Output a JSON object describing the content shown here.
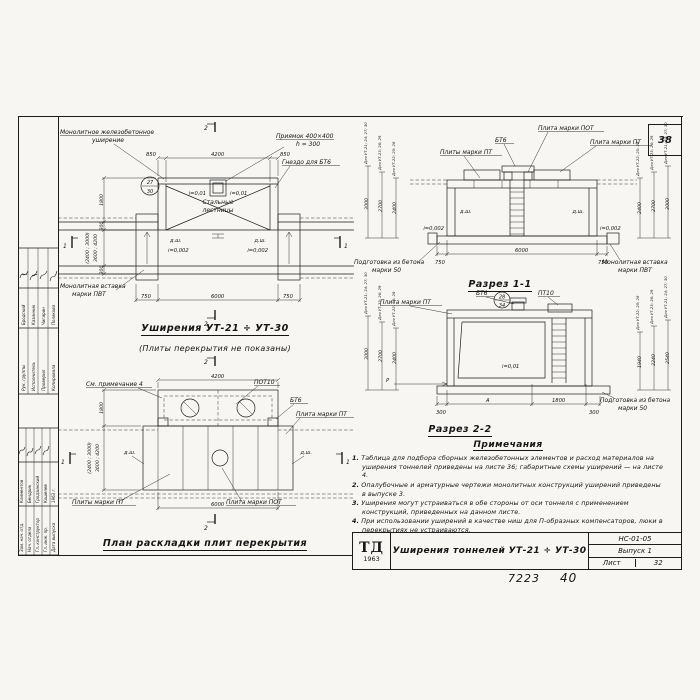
{
  "marks": {
    "one": "1",
    "two": "2"
  },
  "sheet": {
    "corner_page": "38",
    "footer_number": "7223",
    "footer_page": "40"
  },
  "titleblock": {
    "logo": "ТД",
    "logo_year": "1963",
    "title": "Уширения тоннелей УТ-21 ÷ УТ-30",
    "code": "НС-01-05",
    "issue": "Выпуск 1",
    "sheet_label": "Лист",
    "sheet_number": "32"
  },
  "sidebar": {
    "table1": {
      "roles": [
        "Рук. группы",
        "Исполнитель",
        "Проверил",
        "Копировала"
      ],
      "names": [
        "Бродский",
        "Казинник",
        "Чигирин",
        "Полякова"
      ]
    },
    "table2": {
      "roles": [
        "Зам. нач. отд.",
        "Нач. отдела",
        "Гл. конструктор",
        "Гл. инж. пр.",
        "Дата выпуска"
      ],
      "names": [
        "Климентов",
        "Бендрик",
        "Гродзинский",
        "Кошелев",
        "1963 г."
      ]
    }
  },
  "plan_top": {
    "title": "Уширения УТ-21 ÷ УТ-30",
    "subtitle": "(Плиты перекрытия не показаны)",
    "label_monolithic_1": "Монолитное железобетонное",
    "label_monolithic_2": "уширение",
    "label_pit_1": "Приямок 400×400",
    "label_pit_2": "h = 300",
    "label_socket": "Гнездо для БТ6",
    "label_stairs_1": "Стальные",
    "label_stairs_2": "лестницы",
    "label_insert_1": "Монолитная вставка",
    "label_insert_2": "марки ПВТ",
    "callout_top": "27",
    "callout_bottom": "30",
    "slope_pit": "i=0,01",
    "slope_wall": "i=0,002",
    "joint": "д.ш.",
    "dim_850": "850",
    "dim_4200": "4200",
    "dim_750": "750",
    "dim_6000": "6000",
    "dim_1800": "1800",
    "dim_300": "300",
    "dim_span_1": "(2400 ; 3000)",
    "dim_span_2": "3600 ; 4200"
  },
  "section1": {
    "title": "Разрез 1-1",
    "label_bt6": "БТ6",
    "label_pot": "Плита марки ПОТ",
    "label_pt": "Плита марки ПТ",
    "label_pts": "Плиты марки ПТ",
    "label_podg_1": "Подготовка из бетона",
    "label_podg_2": "марки 50",
    "label_insert_1": "Монолитная вставка",
    "label_insert_2": "марки ПВТ",
    "joint": "д.ш.",
    "slope": "i=0,002",
    "dim_750": "750",
    "dim_6000": "6000",
    "left_cols": [
      {
        "label": "Для УТ-21; 24; 27; 30",
        "value": "3000"
      },
      {
        "label": "Для УТ-23; 26; 29",
        "value": "2700"
      },
      {
        "label": "Для УТ-22; 25; 28",
        "value": "2400"
      }
    ],
    "right_cols": [
      {
        "label": "Для УТ-22; 25; 28",
        "value": "2400"
      },
      {
        "label": "Для УТ-23; 26; 29",
        "value": "2700"
      },
      {
        "label": "Для УТ-21; 24; 27; 30",
        "value": "3000"
      }
    ]
  },
  "section2": {
    "title": "Разрез 2-2",
    "label_pt": "Плита марки ПТ",
    "label_bt6": "БТ6",
    "label_pt10": "ПТ10",
    "label_podg_1": "Подготовка из бетона",
    "label_podg_2": "марки 50",
    "slope": "i=0,01",
    "load": "Р",
    "callout_top": "28",
    "callout_bottom": "34",
    "dim_300": "300",
    "dim_a": "А",
    "dim_1800": "1800",
    "left_cols": [
      {
        "label": "Для УТ-21; 24; 27; 30",
        "value": "3000"
      },
      {
        "label": "Для УТ-23; 26; 29",
        "value": "2700"
      },
      {
        "label": "Для УТ-22; 25; 28",
        "value": "2400"
      }
    ],
    "right_cols": [
      {
        "label": "Для УТ-22; 25; 28",
        "value": "1940"
      },
      {
        "label": "Для УТ-23; 26; 29",
        "value": "2240"
      },
      {
        "label": "Для УТ-21; 24; 27; 30",
        "value": "2540"
      }
    ]
  },
  "plan_bottom": {
    "title": "План раскладки плит перекрытия",
    "label_note": "См. примечание 4",
    "label_pot10": "ПОТ10",
    "label_bt6": "БТ6",
    "label_pt": "Плита марки ПТ",
    "label_pts": "Плиты марки ПТ",
    "label_pot": "Плита марки ПОТ",
    "joint": "д.ш.",
    "dim_4200": "4200",
    "dim_6000": "6000",
    "dim_1800": "1800",
    "dim_span_1": "(2400 ; 3000)",
    "dim_span_2": "3600 ; 4200"
  },
  "notes": {
    "title": "Примечания",
    "items": [
      "Таблица для подбора сборных железобетонных элементов и расход материалов на уширения тоннелей приведены на листе 36; габаритные схемы уширений — на листе 4.",
      "Опалубочные и арматурные чертежи монолитных конструкций уширений приведены в выпуске 3.",
      "Уширения могут устраиваться в обе стороны от оси тоннеля с применением конструкций, приведенных на данном листе.",
      "При использовании уширений в качестве ниш для П-образных компенсаторов, люки в перекрытиях не устраиваются."
    ]
  }
}
